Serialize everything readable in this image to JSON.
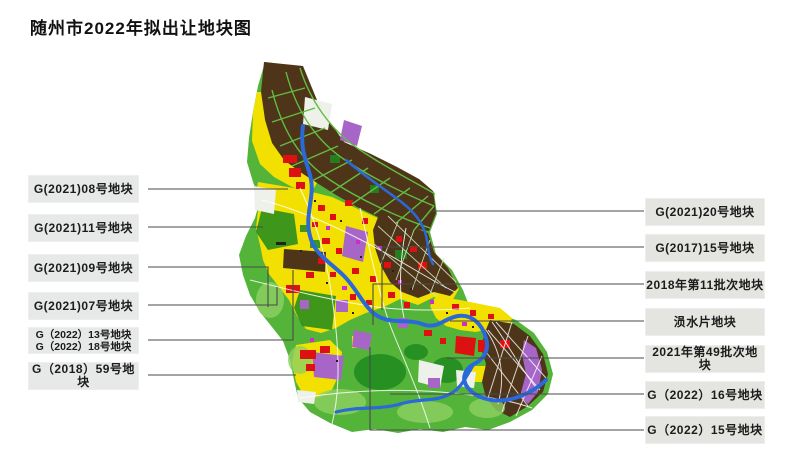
{
  "title": "随州市2022年拟出让地块图",
  "left_labels": [
    {
      "lines": [
        "G(2021)08号地块"
      ]
    },
    {
      "lines": [
        "G(2021)11号地块"
      ]
    },
    {
      "lines": [
        "G(2021)09号地块"
      ]
    },
    {
      "lines": [
        "G(2021)07号地块"
      ]
    },
    {
      "lines": [
        "G（2022）13号地块",
        "G（2022）18号地块"
      ]
    },
    {
      "lines": [
        "G（2018）59号地块"
      ]
    }
  ],
  "right_labels": [
    {
      "lines": [
        "G(2021)20号地块"
      ]
    },
    {
      "lines": [
        "G(2017)15号地块"
      ]
    },
    {
      "lines": [
        "2018年第11批次地块"
      ]
    },
    {
      "lines": [
        "涢水片地块"
      ]
    },
    {
      "lines": [
        "2021年第49批次地块"
      ]
    },
    {
      "lines": [
        "G（2022）16号地块"
      ]
    },
    {
      "lines": [
        "G（2022）15号地块"
      ]
    }
  ],
  "palette": {
    "residential_yellow": "#f2e000",
    "commercial_red": "#dd1111",
    "industrial_brown": "#4e3519",
    "green_space": "#54b43a",
    "dark_green": "#1f8a1f",
    "mixed_purple": "#a765c8",
    "river_blue": "#2b68d8",
    "leader_line": "#4a4a4a",
    "label_box_bg": "#e6e9e8",
    "title_text": "#111111"
  }
}
